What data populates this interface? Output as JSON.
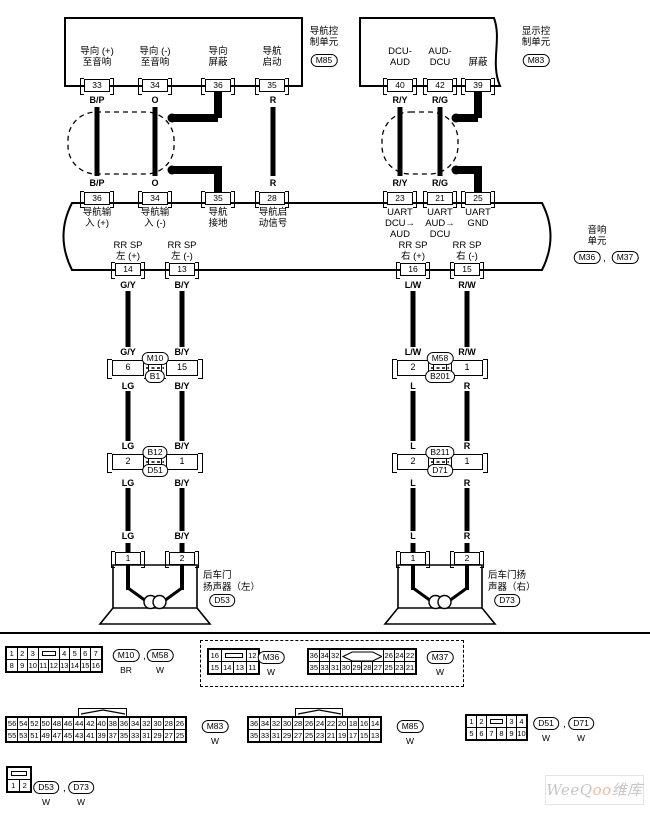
{
  "nav_unit": {
    "name": "导航控\n制单元",
    "code": "M85",
    "pins": [
      {
        "label": "导向 (+)\n至音响",
        "num": "33",
        "wire": "B/P"
      },
      {
        "label": "导向 (-)\n至音响",
        "num": "34",
        "wire": "O"
      },
      {
        "label": "导向\n屏蔽",
        "num": "36",
        "wire": ""
      },
      {
        "label": "导航\n启动",
        "num": "35",
        "wire": "R"
      }
    ]
  },
  "display_unit": {
    "name": "显示控\n制单元",
    "code": "M83",
    "pins": [
      {
        "label": "DCU-\nAUD",
        "num": "40",
        "wire": "R/Y"
      },
      {
        "label": "AUD-\nDCU",
        "num": "42",
        "wire": "R/G"
      },
      {
        "label": "屏蔽",
        "num": "39",
        "wire": ""
      }
    ]
  },
  "audio_unit": {
    "name": "音响\n单元",
    "code1": "M36",
    "comma": ",",
    "code2": "M37",
    "top_pins": [
      {
        "num": "36",
        "label": "导航输\n入 (+)",
        "wire": "B/P"
      },
      {
        "num": "34",
        "label": "导航输\n入 (-)",
        "wire": "O"
      },
      {
        "num": "35",
        "label": "导航\n接地",
        "wire": ""
      },
      {
        "num": "28",
        "label": "导航启\n动信号",
        "wire": "R"
      },
      {
        "num": "23",
        "label": "UART\nDCU→\nAUD",
        "wire": "R/Y"
      },
      {
        "num": "21",
        "label": "UART\nAUD→\nDCU",
        "wire": "R/G"
      },
      {
        "num": "25",
        "label": "UART\nGND",
        "wire": ""
      }
    ],
    "out_pins": [
      {
        "num": "14",
        "label": "RR SP\n左 (+)"
      },
      {
        "num": "13",
        "label": "RR SP\n左 (-)"
      },
      {
        "num": "16",
        "label": "RR SP\n右 (+)"
      },
      {
        "num": "15",
        "label": "RR SP\n右 (-)"
      }
    ]
  },
  "branches": [
    {
      "w1": "G/Y",
      "w2": "G/Y",
      "j1": "6",
      "w3": "LG",
      "w4": "LG",
      "j2": "2",
      "w5": "LG",
      "w6": "LG",
      "spk": "1"
    },
    {
      "w1": "B/Y",
      "w2": "B/Y",
      "j1": "15",
      "w3": "B/Y",
      "w4": "B/Y",
      "j2": "1",
      "w5": "B/Y",
      "w6": "B/Y",
      "spk": "2"
    },
    {
      "w1": "L/W",
      "w2": "L/W",
      "j1": "2",
      "w3": "L",
      "w4": "L",
      "j2": "2",
      "w5": "L",
      "w6": "L",
      "spk": "1"
    },
    {
      "w1": "R/W",
      "w2": "R/W",
      "j1": "1",
      "w3": "R",
      "w4": "R",
      "j2": "1",
      "w5": "R",
      "w6": "R",
      "spk": "2"
    }
  ],
  "joints": [
    {
      "top": "M10",
      "bottom": "B1"
    },
    {
      "top": "M58",
      "bottom": "B201"
    },
    {
      "top": "B12",
      "bottom": "D51"
    },
    {
      "top": "B211",
      "bottom": "D71"
    }
  ],
  "speakers": [
    {
      "label": "后车门\n扬声器（左）",
      "code": "D53"
    },
    {
      "label": "后车门扬\n声器（右）",
      "code": "D73"
    }
  ],
  "tables": {
    "m10": {
      "rows": [
        [
          "1",
          "2",
          "3",
          "KEYR:2",
          "4",
          "5",
          "6",
          "7"
        ],
        [
          "8",
          "9",
          "10",
          "11",
          "12",
          "13",
          "14",
          "15",
          "16"
        ]
      ]
    },
    "m36": {
      "rows": [
        [
          "16",
          "KEYR:2",
          "12"
        ],
        [
          "15",
          "14",
          "13",
          "11"
        ]
      ]
    },
    "m37": {
      "rows": [
        [
          "36",
          "34",
          "32",
          "KEYD:4",
          "26",
          "24",
          "22"
        ],
        [
          "35",
          "33",
          "31",
          "30",
          "29",
          "28",
          "27",
          "25",
          "23",
          "21"
        ]
      ]
    },
    "m83": {
      "rows": [
        [
          "56",
          "54",
          "52",
          "50",
          "48",
          "46",
          "44",
          "42",
          "40",
          "38",
          "36",
          "34",
          "32",
          "30",
          "28",
          "26"
        ],
        [
          "55",
          "53",
          "51",
          "49",
          "47",
          "45",
          "43",
          "41",
          "39",
          "37",
          "35",
          "33",
          "31",
          "29",
          "27",
          "25"
        ]
      ]
    },
    "m85": {
      "rows": [
        [
          "36",
          "34",
          "32",
          "30",
          "28",
          "26",
          "24",
          "22",
          "20",
          "18",
          "16",
          "14"
        ],
        [
          "35",
          "33",
          "31",
          "29",
          "27",
          "25",
          "23",
          "21",
          "19",
          "17",
          "15",
          "13"
        ]
      ]
    },
    "d51": {
      "rows": [
        [
          "1",
          "2",
          "KEYR:2",
          "3",
          "4"
        ],
        [
          "5",
          "6",
          "7",
          "8",
          "9",
          "10"
        ]
      ]
    },
    "d53": {
      "rows": [
        [
          "KEYR:2"
        ],
        [
          "1",
          "2"
        ]
      ]
    }
  },
  "table_labels": {
    "m10": {
      "c1": "M10",
      "col1": "BR",
      "comma": ",",
      "c2": "M58",
      "col2": "W"
    },
    "m36": {
      "c": "M36",
      "col": "W"
    },
    "m37": {
      "c": "M37",
      "col": "W"
    },
    "m83": {
      "c": "M83",
      "col": "W"
    },
    "m85": {
      "c": "M85",
      "col": "W"
    },
    "d51": {
      "c1": "D51",
      "col1": "W",
      "comma": ",",
      "c2": "D71",
      "col2": "W"
    },
    "d53": {
      "c1": "D53",
      "col1": "W",
      "comma": ",",
      "c2": "D73",
      "col2": "W"
    }
  },
  "watermark": {
    "p1": "WeeQ",
    "p2": "oo",
    "p3": "维库"
  }
}
